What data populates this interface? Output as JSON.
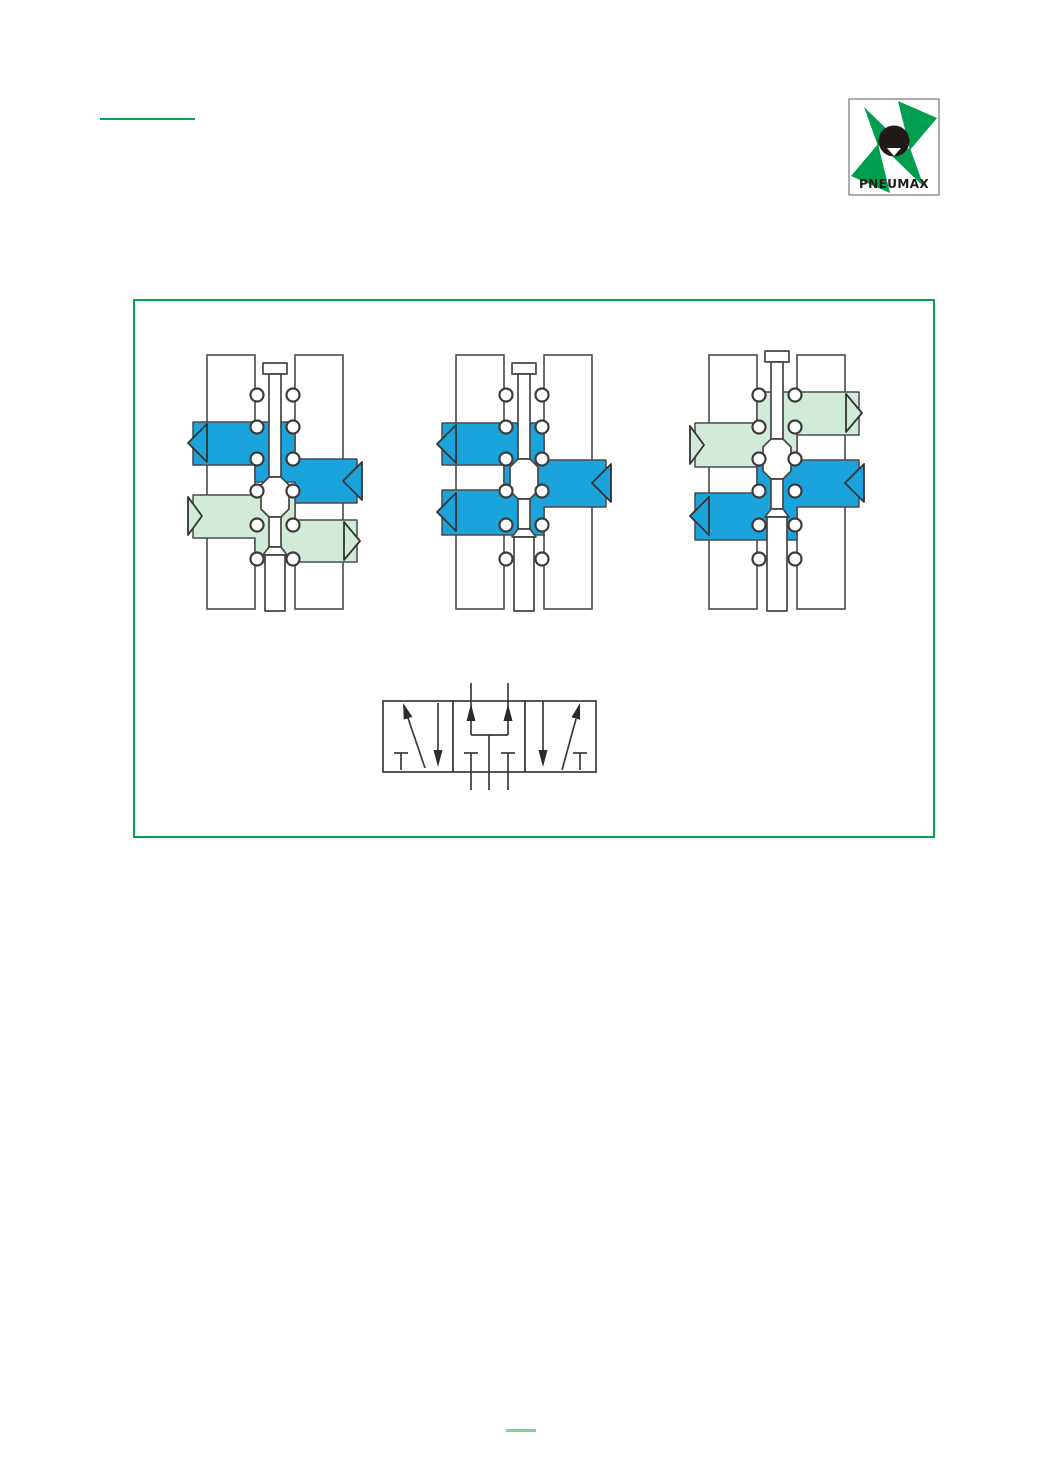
{
  "header": {
    "rule_color": "#00A75A",
    "logo": {
      "text": "PNEUMAX",
      "green": "#009E4F",
      "black": "#1f1a17",
      "border": "#5a5a5a"
    }
  },
  "diagram_panel": {
    "border_color": "#00A551",
    "colors": {
      "pressure_blue": "#1BA3DB",
      "exhaust_green": "#D0ECD8",
      "outline": "#4a4a4a",
      "spool_fill": "#ffffff",
      "symbol_line": "#3a3a3a"
    },
    "valves": [
      {
        "id": "valve-position-left",
        "spool": {
          "top": 16,
          "land": 130
        },
        "channels": [
          {
            "color": "blue",
            "path": "M8,75 L110,75 L110,112 L172,112 L172,156 L110,156 L110,135 L70,135 L70,118 L8,118 Z"
          },
          {
            "color": "green",
            "path": "M8,148 L110,148 L110,173 L172,173 L172,215 L70,215 L70,191 L8,191 Z"
          }
        ],
        "arrows": [
          {
            "color": "blue",
            "points": "22,77 22,115 3,96"
          },
          {
            "color": "blue",
            "points": "177,115 177,153 158,134"
          },
          {
            "color": "green",
            "points": "3,150 3,188 17,169"
          },
          {
            "color": "green",
            "points": "159,175 159,213 175,194"
          }
        ]
      },
      {
        "id": "valve-position-center",
        "spool": {
          "top": 16,
          "land": 112
        },
        "channels": [
          {
            "color": "blue",
            "path": "M8,76 L110,76 L110,113 L172,113 L172,160 L110,160 L110,188 L8,188 L8,143 L70,143 L70,118 L8,118 Z"
          }
        ],
        "arrows": [
          {
            "color": "blue",
            "points": "22,78 22,116 3,97"
          },
          {
            "color": "blue",
            "points": "177,117 177,155 158,136"
          },
          {
            "color": "blue",
            "points": "22,146 22,184 3,165"
          }
        ]
      },
      {
        "id": "valve-position-right",
        "spool": {
          "top": 4,
          "land": 92
        },
        "channels": [
          {
            "color": "green",
            "path": "M8,76 L70,76 L70,45 L172,45 L172,88 L110,88 L110,120 L8,120 Z"
          },
          {
            "color": "blue",
            "path": "M70,113 L172,113 L172,160 L110,160 L110,193 L8,193 L8,146 L70,146 Z"
          }
        ],
        "arrows": [
          {
            "color": "green",
            "points": "3,79 3,117 17,98"
          },
          {
            "color": "green",
            "points": "159,47 159,85 175,66"
          },
          {
            "color": "blue",
            "points": "177,117 177,155 158,136"
          },
          {
            "color": "blue",
            "points": "22,150 22,188 3,169"
          }
        ]
      }
    ],
    "rings": {
      "rows": [
        48,
        80,
        112,
        144,
        178,
        212
      ],
      "xs": [
        72,
        108
      ],
      "r": 6.5
    },
    "symbol": {
      "boxes": [
        {
          "x": 15,
          "y": 41,
          "w": 70,
          "h": 71
        },
        {
          "x": 85,
          "y": 41,
          "w": 72,
          "h": 71
        },
        {
          "x": 157,
          "y": 41,
          "w": 71,
          "h": 71
        }
      ],
      "lines": [
        [
          57,
          108,
          40,
          58
        ],
        [
          70,
          43,
          70,
          92
        ],
        [
          26,
          93,
          40,
          93
        ],
        [
          33,
          93,
          33,
          110
        ],
        [
          103,
          23,
          103,
          75
        ],
        [
          140,
          23,
          140,
          75
        ],
        [
          103,
          75,
          140,
          75
        ],
        [
          121,
          75,
          121,
          130
        ],
        [
          96,
          93,
          110,
          93
        ],
        [
          103,
          93,
          103,
          130
        ],
        [
          133,
          93,
          147,
          93
        ],
        [
          140,
          93,
          140,
          130
        ],
        [
          175,
          41,
          175,
          92
        ],
        [
          194,
          110,
          208,
          59
        ],
        [
          205,
          93,
          219,
          93
        ],
        [
          212,
          93,
          212,
          110
        ]
      ],
      "arrowheads": [
        "35,43 44.4,56.8 35.8,59.6",
        "70,107 65.5,90 74.5,90",
        "103,44 98.5,61 107.5,61",
        "140,44 135.5,61 144.5,61",
        "175,107 170.5,90 179.5,90",
        "212,43 212.1,59.7 203.5,57.3"
      ]
    }
  },
  "footer": {
    "rule_color": "#7FCFA1"
  }
}
